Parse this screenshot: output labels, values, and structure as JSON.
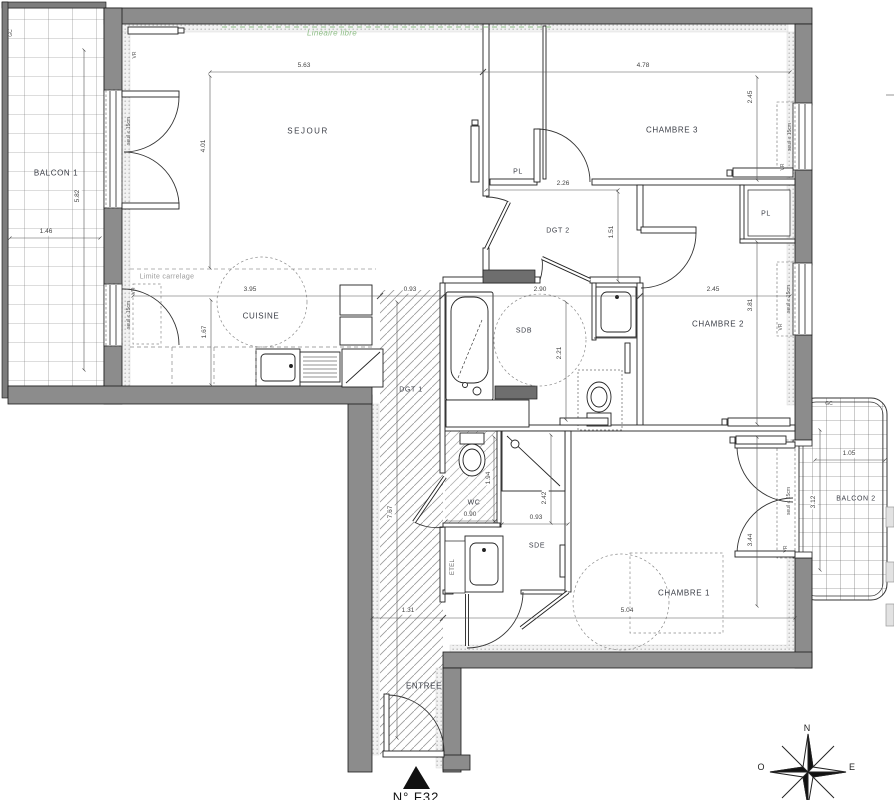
{
  "unit_label": "N° F32",
  "rooms": {
    "balcon1": "BALCON 1",
    "sejour": "SEJOUR",
    "chambre3": "CHAMBRE 3",
    "dgt2": "DGT 2",
    "pl": "PL",
    "cuisine": "CUISINE",
    "sdb": "SDB",
    "chambre2": "CHAMBRE 2",
    "dgt1": "DGT 1",
    "wc": "WC",
    "sde": "SDE",
    "etel": "ETEL",
    "chambre1": "CHAMBRE 1",
    "balcon2": "BALCON 2",
    "entree": "ENTREE"
  },
  "annotations": {
    "lineaire_libre": "Linéaire libre",
    "limite_carrelage": "Limite carrelage",
    "seuil": "seuil ≤ 15cm",
    "vr": "VR",
    "gc": "GC"
  },
  "dimensions": {
    "sejour_width": "5.63",
    "chambre3_width": "4.78",
    "chambre3_height": "2.45",
    "sejour_height": "4.01",
    "balcon1_height": "5.82",
    "balcon1_width": "1.46",
    "dgt2_width": "2.26",
    "dgt2_height": "1.51",
    "cuisine_width": "3.95",
    "cuisine_height": "1.67",
    "dgt1_width": "0.93",
    "dgt1_length": "7.67",
    "sdb_width": "2.90",
    "sdb_height": "2.21",
    "chambre2_width": "2.45",
    "chambre2_height": "3.81",
    "wc_width": "0.90",
    "wc_height": "1.94",
    "sde_width": "0.93",
    "sde_height": "2.42",
    "entree_width": "1.31",
    "chambre1_width": "5.04",
    "chambre1_height": "3.44",
    "balcon2_width": "1.05",
    "balcon2_height": "3.12"
  },
  "compass": {
    "north": "N",
    "west": "O",
    "east": "E"
  },
  "colors": {
    "wall": "#8c8c8c",
    "line": "#222222",
    "green_annotation": "#8fbf87",
    "dim_text": "#444444"
  }
}
